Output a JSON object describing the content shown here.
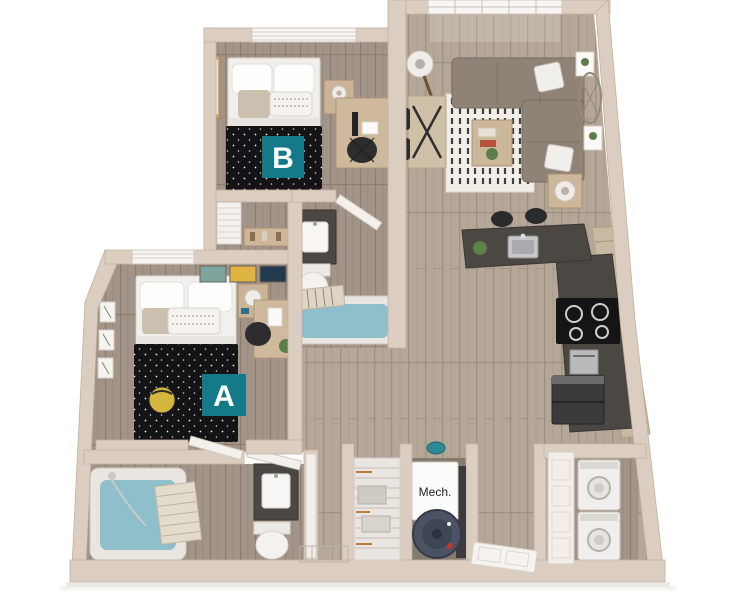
{
  "title": "3D apartment floor plan render, two bedrooms",
  "background_color": "#ffffff",
  "badges": {
    "a": "A",
    "b": "B"
  },
  "labels": {
    "mech": "Mech."
  },
  "palette": {
    "accent_teal": "#147a8a",
    "wall": "#dbcec0",
    "wall_edge": "#c2b1a0",
    "floor_light_wood": "#b5a798",
    "floor_dark_wood": "#a29488",
    "counter_dark": "#4b4743",
    "cabinet_wood": "#c9b8a2",
    "duvet_black": "#141416",
    "linen_white": "#f2f0ed",
    "water_blue": "#8fbfca",
    "sofa_gray": "#8e8376",
    "appliance_dark": "#3a393b",
    "stainless": "#b9babc",
    "door_white": "#f4f1ed"
  },
  "rooms": [
    {
      "name": "bedroom-b",
      "badge": "B",
      "furniture": [
        "bed",
        "nightstand",
        "table-lamp",
        "desk",
        "office-chair",
        "window-blinds",
        "wall-mirror",
        "louvered-closet",
        "console-table"
      ]
    },
    {
      "name": "living-room",
      "furniture": [
        "sectional-sofa",
        "throw-pillows",
        "striped-rug",
        "coffee-table",
        "side-table",
        "floor-lamp",
        "dining-table",
        "dining-chairs",
        "window",
        "plant-frames",
        "oval-mirror"
      ]
    },
    {
      "name": "kitchen",
      "furniture": [
        "island-with-sink",
        "bar-stools",
        "cooktop",
        "wall-oven",
        "refrigerator",
        "slat-cabinets"
      ]
    },
    {
      "name": "bathroom-1",
      "furniture": [
        "vanity-sink",
        "toilet",
        "bathtub",
        "shower-curtain",
        "door"
      ]
    },
    {
      "name": "bedroom-a",
      "badge": "A",
      "furniture": [
        "bed",
        "nightstand",
        "desk",
        "office-chair",
        "pouf",
        "window-blinds",
        "wall-art",
        "door"
      ]
    },
    {
      "name": "bathroom-2",
      "furniture": [
        "bathtub",
        "towel",
        "vanity-sink",
        "toilet",
        "drying-rack",
        "door"
      ]
    },
    {
      "name": "storage-closet",
      "furniture": [
        "wire-shelving",
        "baskets"
      ]
    },
    {
      "name": "mech-room",
      "label": "Mech.",
      "furniture": [
        "furnace",
        "water-heater"
      ]
    },
    {
      "name": "entry",
      "furniture": [
        "front-door"
      ]
    },
    {
      "name": "laundry-closet",
      "furniture": [
        "stacked-washer-dryer",
        "closet-door"
      ]
    }
  ]
}
